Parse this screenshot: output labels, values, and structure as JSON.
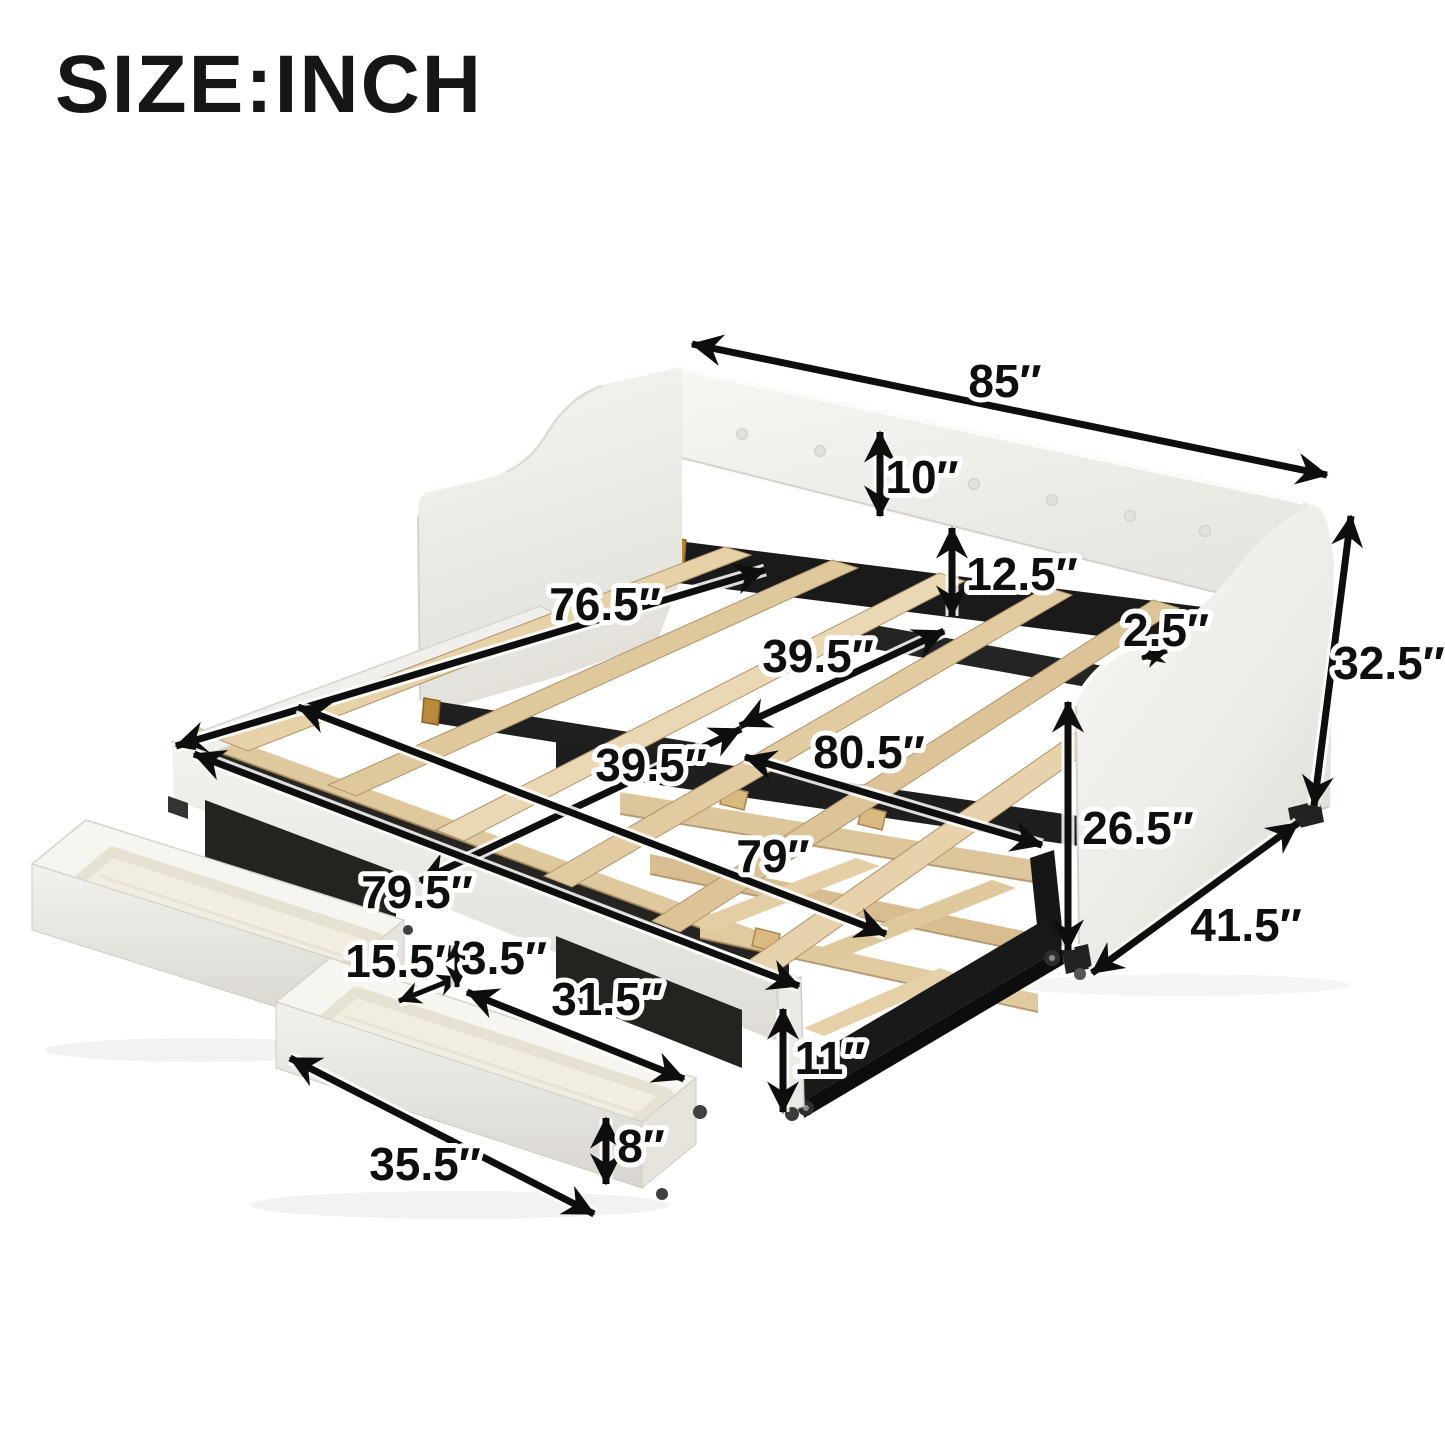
{
  "title": "SIZE:INCH",
  "dimensions": {
    "overall_length": "85″",
    "backrest_height": "10″",
    "back_clearance_height": "12.5″",
    "inner_length": "76.5″",
    "daybed_slat_width": "39.5″",
    "arm_thickness": "2.5″",
    "overall_height": "32.5″",
    "extended_length": "80.5″",
    "trundle_width": "39.5″",
    "trundle_length": "79″",
    "side_height": "26.5″",
    "overall_depth": "41.5″",
    "frame_length": "79.5″",
    "drawer_gap_width": "15.5″",
    "drawer_gap_height": "3.5″",
    "drawer_inner_length": "31.5″",
    "frame_front_height": "11″",
    "drawer_length": "35.5″",
    "drawer_height": "8″"
  }
}
